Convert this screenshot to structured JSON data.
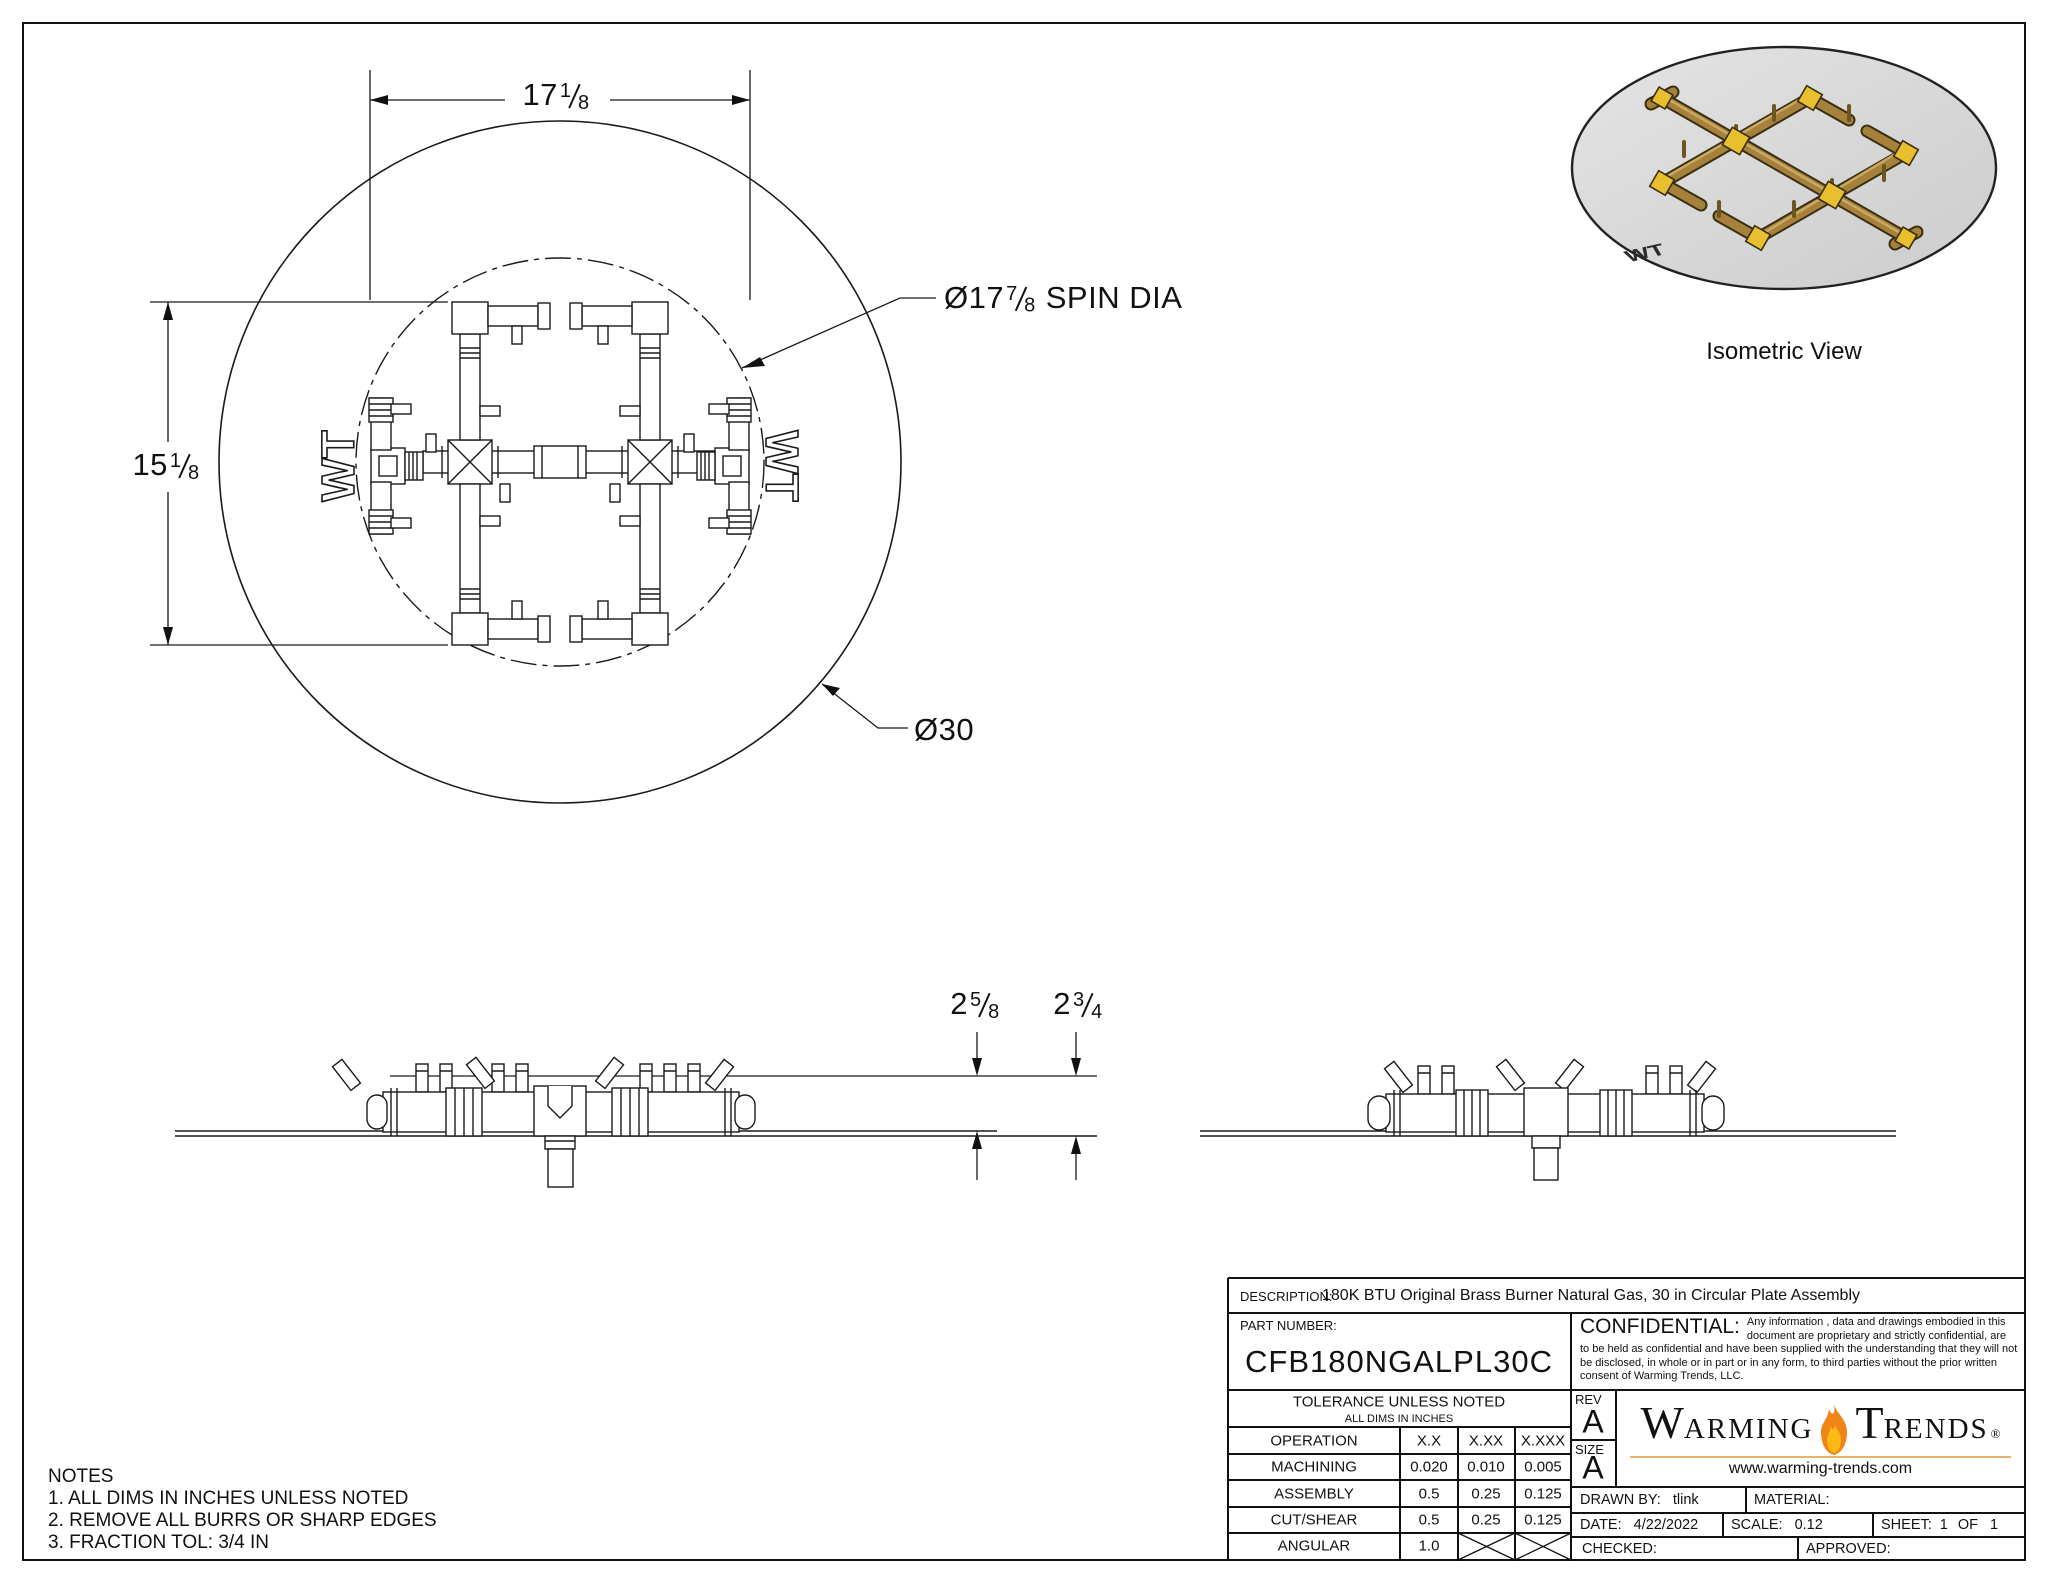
{
  "page": {
    "bg": "#ffffff",
    "line_color": "#1a1a1a"
  },
  "plan_view": {
    "dim_width": {
      "whole": "17",
      "num": "1",
      "den": "8"
    },
    "dim_height": {
      "whole": "15",
      "num": "1",
      "den": "8"
    },
    "spin_label": {
      "prefix": "Ø17",
      "num": "7",
      "den": "8",
      "suffix": "SPIN DIA"
    },
    "plate_label": "Ø30",
    "wt_mark": "WT"
  },
  "side_view": {
    "dim_left": {
      "whole": "2",
      "num": "5",
      "den": "8"
    },
    "dim_right": {
      "whole": "2",
      "num": "3",
      "den": "4"
    }
  },
  "iso_view": {
    "caption": "Isometric View",
    "plate_color": "#d7d7d7",
    "brass": "#a5813c",
    "brass_dark": "#5d4a1e",
    "fitting": "#e8bf2e",
    "wt_mark": "WT"
  },
  "notes": {
    "title": "NOTES",
    "items": [
      "1. ALL DIMS IN INCHES UNLESS NOTED",
      "2. REMOVE ALL BURRS OR SHARP EDGES",
      "3. FRACTION TOL: 3/4 IN"
    ]
  },
  "title_block": {
    "description_label": "DESCRIPTION:",
    "description": "180K BTU Original Brass Burner Natural Gas, 30 in Circular Plate Assembly",
    "part_number_label": "PART NUMBER:",
    "part_number": "CFB180NGALPL30C",
    "confidential_label": "CONFIDENTIAL:",
    "confidential_text": "Any information , data and drawings embodied in this document are proprietary and strictly confidential, are to be held as confidential and have been supplied with the understanding that they will not be disclosed, in whole or in part or in any form, to third parties without the prior written consent of Warming Trends, LLC.",
    "tolerance": {
      "title": "TOLERANCE UNLESS NOTED",
      "subtitle": "ALL DIMS IN INCHES",
      "columns": [
        "OPERATION",
        "X.X",
        "X.XX",
        "X.XXX"
      ],
      "rows": [
        [
          "MACHINING",
          "0.020",
          "0.010",
          "0.005"
        ],
        [
          "ASSEMBLY",
          "0.5",
          "0.25",
          "0.125"
        ],
        [
          "CUT/SHEAR",
          "0.5",
          "0.25",
          "0.125"
        ],
        [
          "ANGULAR",
          "1.0",
          "",
          ""
        ]
      ]
    },
    "rev_label": "REV",
    "rev": "A",
    "size_label": "SIZE",
    "size": "A",
    "brand": {
      "word1_initial": "W",
      "word1_rest": "ARMING",
      "word2_initial": "T",
      "word2_rest": "RENDS",
      "registered": "®",
      "website": "www.warming-trends.com",
      "flame_color": "#ef8418",
      "underline_color": "#e7b469"
    },
    "fields": {
      "drawn_by_label": "DRAWN BY:",
      "drawn_by": "tlink",
      "material_label": "MATERIAL:",
      "material": "",
      "date_label": "DATE:",
      "date": "4/22/2022",
      "scale_label": "SCALE:",
      "scale": "0.12",
      "sheet_label": "SHEET:",
      "sheet_num": "1",
      "sheet_of": "OF",
      "sheet_total": "1",
      "checked_label": "CHECKED:",
      "checked": "",
      "approved_label": "APPROVED:",
      "approved": ""
    }
  }
}
